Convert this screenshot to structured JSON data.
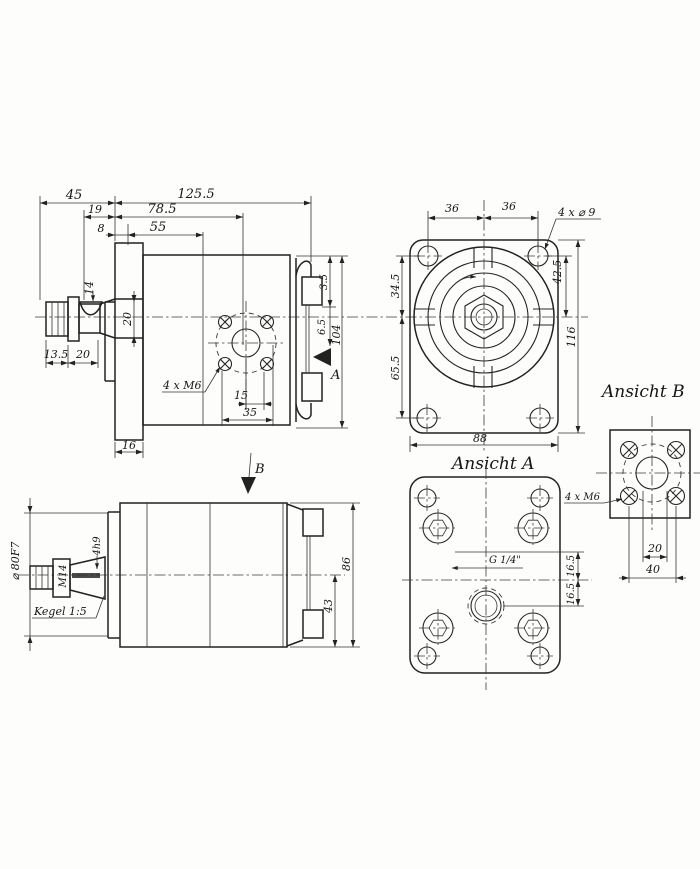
{
  "drawing": {
    "ink": "#222222",
    "background": "#fdfdfc",
    "side_view": {
      "dim_45": "45",
      "dim_125_5": "125.5",
      "dim_19": "19",
      "dim_78_5": "78.5",
      "dim_8": "8",
      "dim_55": "55",
      "dim_key": "14",
      "dim_pilot": "20",
      "dim_13_5": "13.5",
      "dim_20": "20",
      "label_bolts": "4 x M6",
      "dim_15": "15",
      "dim_35": "35",
      "dim_16": "16",
      "dim_3_5": "3.5",
      "dim_6_5": "6.5",
      "dim_104": "104",
      "view_arrow": "A"
    },
    "front_view": {
      "dim_36_left": "36",
      "dim_36_right": "36",
      "label_holes": "4 x ⌀ 9",
      "dim_42_5": "42.5",
      "dim_34_5": "34.5",
      "dim_65_5": "65.5",
      "dim_116": "116",
      "dim_88": "88"
    },
    "view_a": {
      "title": "Ansicht A",
      "label_port": "G 1/4\"",
      "dim_16_5_top": "16.5",
      "dim_16_5_bottom": "16.5"
    },
    "view_b": {
      "title": "Ansicht B",
      "label_bolts": "4 x M6",
      "dim_20": "20",
      "dim_40": "40"
    },
    "top_view": {
      "view_arrow": "B",
      "dim_shaft": "⌀ 80F7",
      "label_thread": "M14",
      "dim_key": "4h9",
      "label_taper": "Kegel 1:5",
      "dim_86": "86",
      "dim_43": "43"
    }
  }
}
